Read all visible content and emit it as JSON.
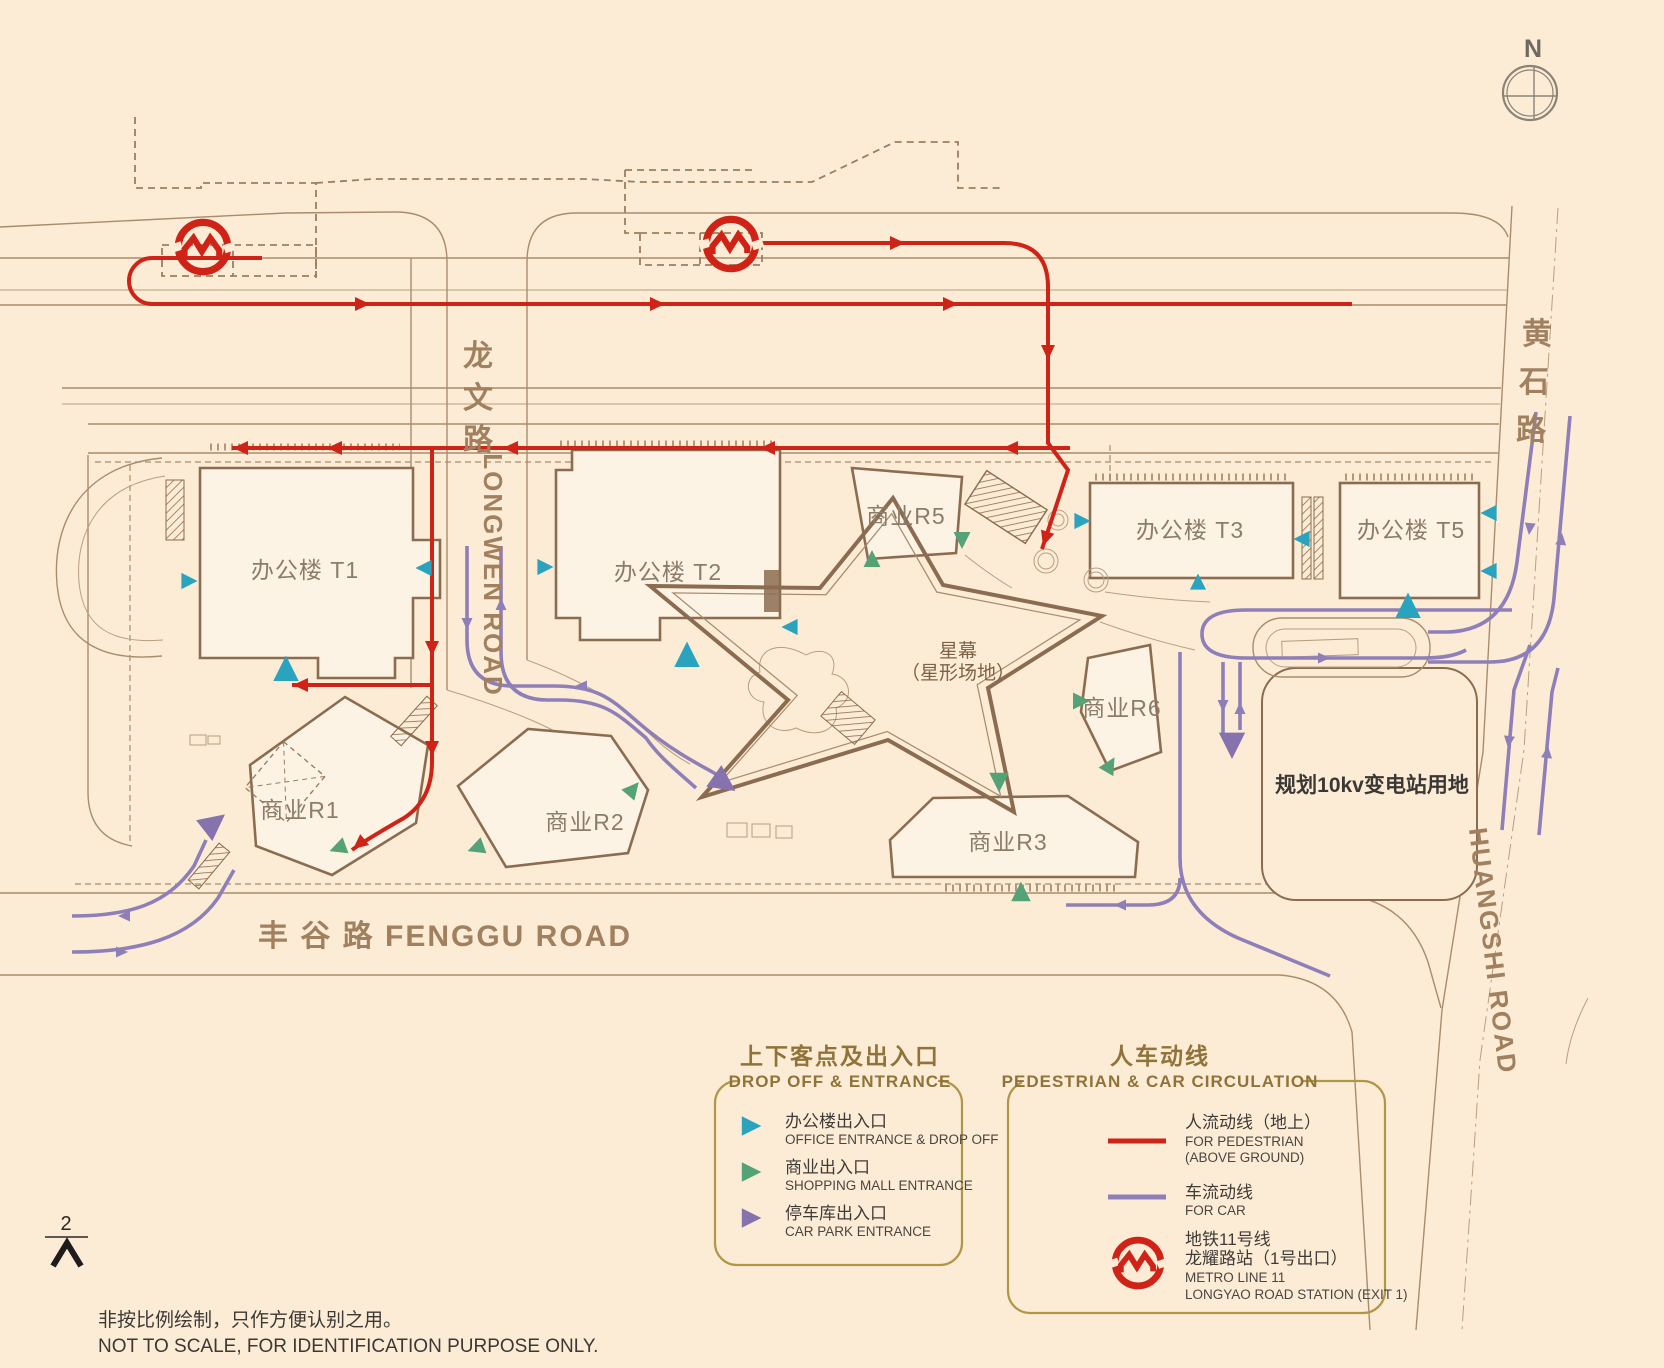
{
  "compass": {
    "label": "N"
  },
  "roads": {
    "longwen_cn": [
      "龙",
      "文",
      "路"
    ],
    "longwen_en": "LONGWEN ROAD",
    "huangshi_cn": [
      "黄",
      "石",
      "路"
    ],
    "huangshi_en": "HUANGSHI ROAD",
    "fenggu_label": "丰 谷 路  FENGGU ROAD"
  },
  "buildings": {
    "t1": "办公楼 T1",
    "t2": "办公楼 T2",
    "t3": "办公楼 T3",
    "t5": "办公楼 T5",
    "r1": "商业R1",
    "r2": "商业R2",
    "r3": "商业R3",
    "r5": "商业R5",
    "r6": "商业R6"
  },
  "plaza": {
    "line1": "星幕",
    "line2": "（星形场地）"
  },
  "substation_label": "规划10kv变电站用地",
  "page_marker": "2",
  "disclaimer": {
    "cn": "非按比例绘制，只作方便认别之用。",
    "en": "NOT TO SCALE, FOR IDENTIFICATION PURPOSE ONLY."
  },
  "legend_entrance": {
    "title_cn": "上下客点及出入口",
    "title_en": "DROP OFF & ENTRANCE",
    "items": [
      {
        "cn": "办公楼出入口",
        "en": "OFFICE ENTRANCE & DROP OFF",
        "color": "#2aa3be"
      },
      {
        "cn": "商业出入口",
        "en": "SHOPPING MALL ENTRANCE",
        "color": "#55a277"
      },
      {
        "cn": "停车库出入口",
        "en": "CAR PARK ENTRANCE",
        "color": "#8672ac"
      }
    ]
  },
  "legend_circulation": {
    "title_cn": "人车动线",
    "title_en": "PEDESTRIAN  & CAR CIRCULATION",
    "pedestrian": {
      "cn": "人流动线（地上）",
      "en_1": "FOR PEDESTRIAN",
      "en_2": "(ABOVE GROUND)"
    },
    "car": {
      "cn": "车流动线",
      "en": "FOR CAR"
    },
    "metro": {
      "cn_1": "地铁11号线",
      "cn_2": "龙耀路站（1号出口）",
      "en_1": "METRO LINE 11",
      "en_2": "LONGYAO ROAD STATION (EXIT 1)"
    }
  },
  "colors": {
    "background": "#fcecd6",
    "pedestrian_red": "#d02317",
    "car_purple": "#8f7fb8",
    "office_teal": "#2aa3be",
    "mall_green": "#55a277",
    "carpark_purple": "#8672ac",
    "legend_gold": "#b09647",
    "line_brown": "#aa8c6d"
  }
}
